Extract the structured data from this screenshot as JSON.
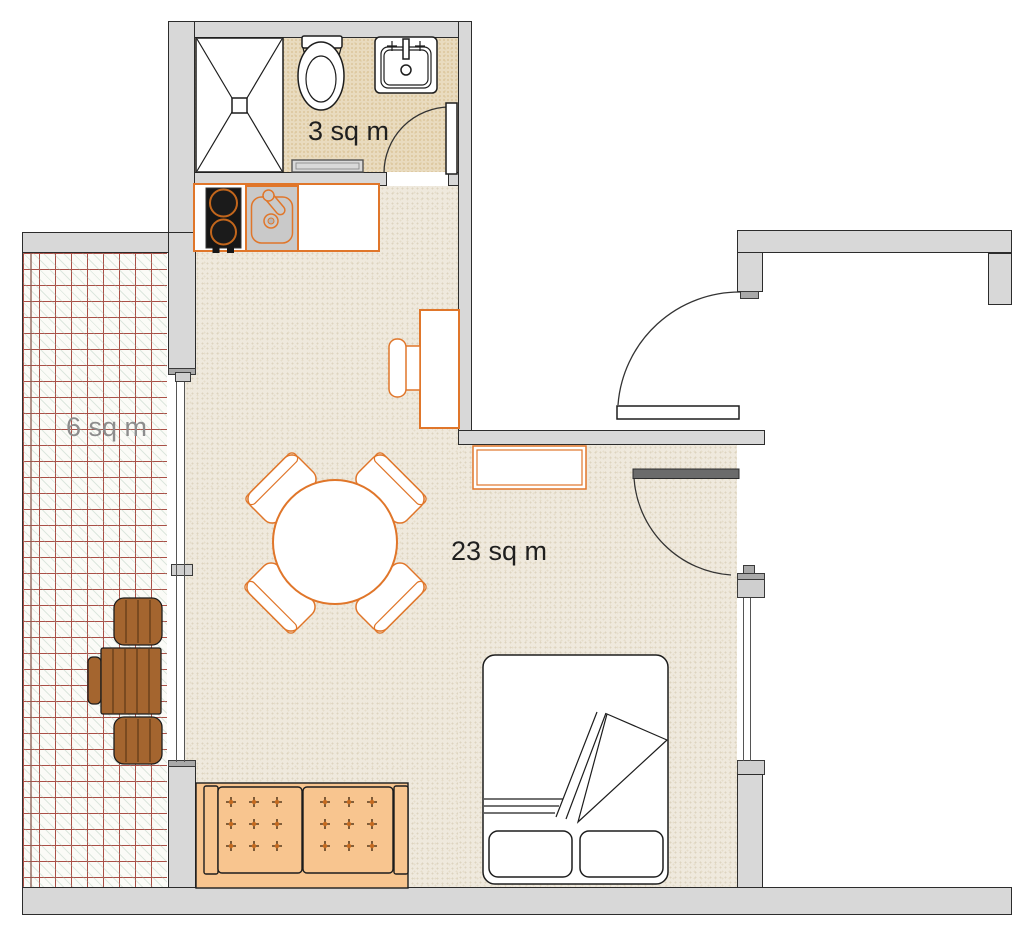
{
  "plan": {
    "labels": {
      "bathroom": "3 sq m",
      "main_room": "23 sq m",
      "balcony": "6 sq m"
    },
    "rooms": [
      {
        "id": "bathroom",
        "area_label": "3 sq m",
        "furniture": [
          "shower",
          "toilet",
          "washbasin",
          "bath-mat",
          "bathroom-door"
        ]
      },
      {
        "id": "main-room",
        "area_label": "23 sq m",
        "furniture": [
          "kitchen-counter",
          "stove",
          "kitchen-sink",
          "desk",
          "desk-chair",
          "sideboard",
          "dining-table",
          "dining-chair x4",
          "double-bed",
          "sofa",
          "entry-door",
          "room-door"
        ]
      },
      {
        "id": "balcony",
        "area_label": "6 sq m",
        "furniture": [
          "outdoor-table",
          "outdoor-chair x2",
          "folded-chair"
        ]
      }
    ],
    "colors": {
      "wall_fill": "#d8d8d8",
      "line_dark": "#1d1d1d",
      "furniture_accent": "#e0762a",
      "sofa_fill": "#f8c58f",
      "wood_fill": "#a4652f",
      "bath_floor": "#e9dbbf",
      "main_floor": "#efe9dd",
      "balcony_grid": "#aa4f46",
      "label_dark": "#1f1f1f",
      "label_gray": "#8d8d8d"
    }
  }
}
